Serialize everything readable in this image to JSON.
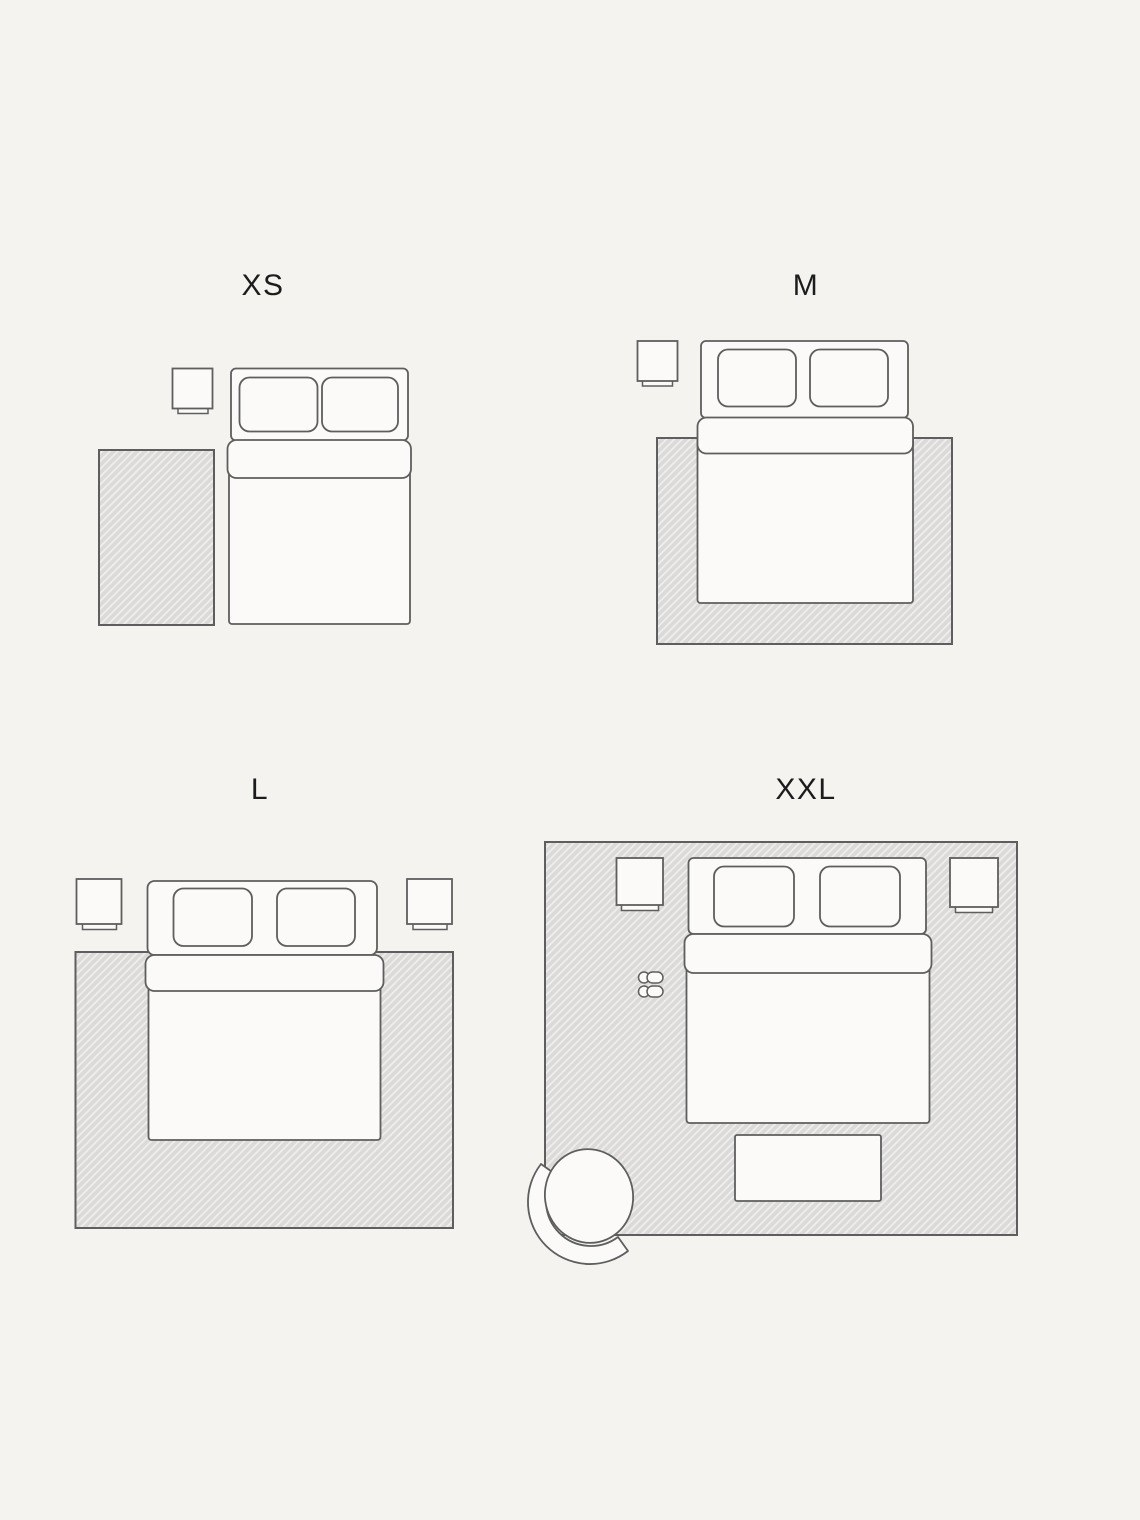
{
  "diagram": {
    "type": "rug-size-guide-bedroom-floorplans",
    "layouts": [
      {
        "id": "xs",
        "label": "XS",
        "objects": [
          "nightstand",
          "double-bed-with-two-pillows",
          "rug-beside-bed"
        ]
      },
      {
        "id": "m",
        "label": "M",
        "objects": [
          "nightstand",
          "double-bed-with-two-pillows",
          "rug-under-lower-half-of-bed"
        ]
      },
      {
        "id": "l",
        "label": "L",
        "objects": [
          "nightstand-left",
          "nightstand-right",
          "double-bed-with-two-pillows",
          "rug-under-bed-full-width"
        ]
      },
      {
        "id": "xxl",
        "label": "XXL",
        "objects": [
          "room-size-rug",
          "nightstand-left",
          "nightstand-right",
          "double-bed-with-two-pillows",
          "slippers",
          "bench-at-foot-of-bed",
          "armchair"
        ]
      }
    ]
  },
  "colors": {
    "bg": "#f4f3f0",
    "line": "#5e5e5e",
    "furn": "#fbfaf8",
    "label": "#1c1c1c",
    "rug-base": "#dbdad8",
    "rug-hatch": "#efeeec"
  }
}
